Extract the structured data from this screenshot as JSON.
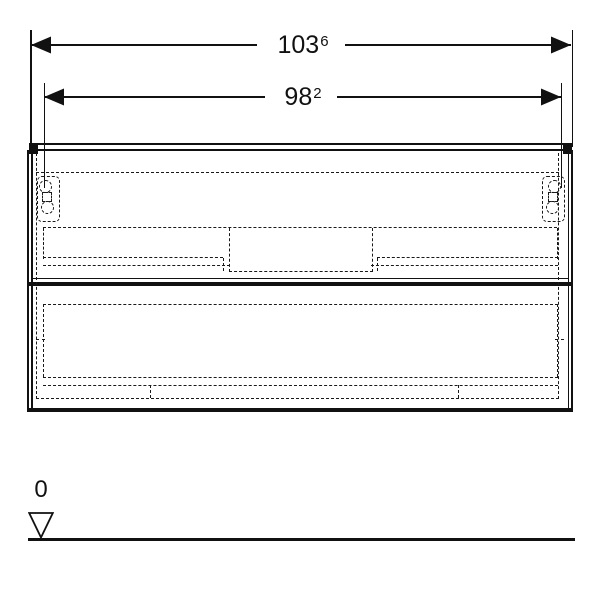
{
  "dimensions": {
    "overall_width": {
      "value": "103",
      "sup": "6",
      "display": "103.6"
    },
    "inner_width": {
      "value": "98",
      "sup": "2",
      "display": "98.2"
    }
  },
  "datum": {
    "label": "0"
  },
  "colors": {
    "line": "#111111",
    "hidden_line": "#191919",
    "background": "#ffffff"
  }
}
